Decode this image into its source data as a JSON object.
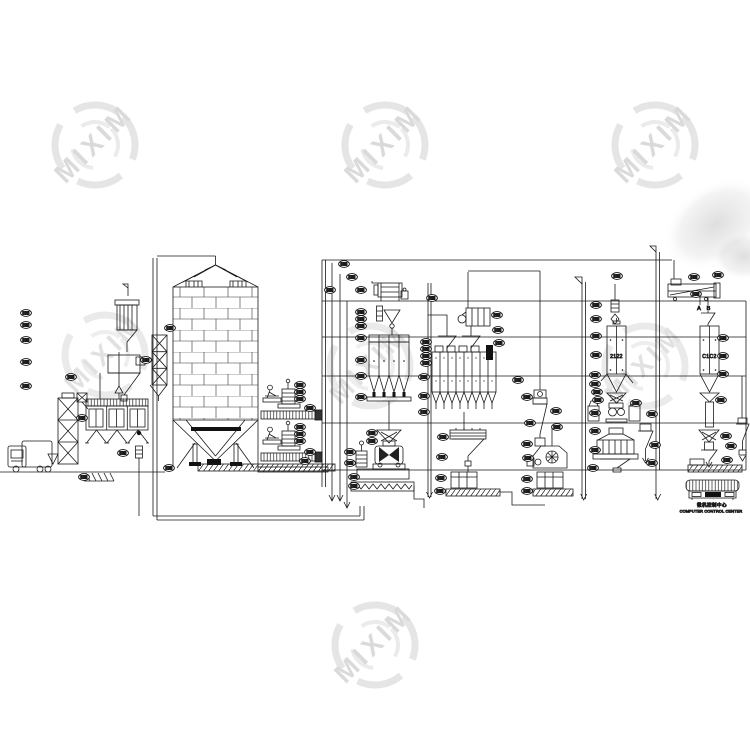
{
  "watermark": {
    "text": "MIXIM"
  },
  "labels": {
    "outlet_a": "A",
    "outlet_b": "B",
    "bin_code_left": "2122",
    "bin_code_right": "C1C2"
  },
  "console": {
    "title_zh": "微机控制中心",
    "title_en": "COMPUTER CONTROL CENTER"
  },
  "colors": {
    "line": "#1a1a1a",
    "background": "#ffffff",
    "watermark": "#d7d7d7",
    "shadow": "#c4c4c4"
  }
}
